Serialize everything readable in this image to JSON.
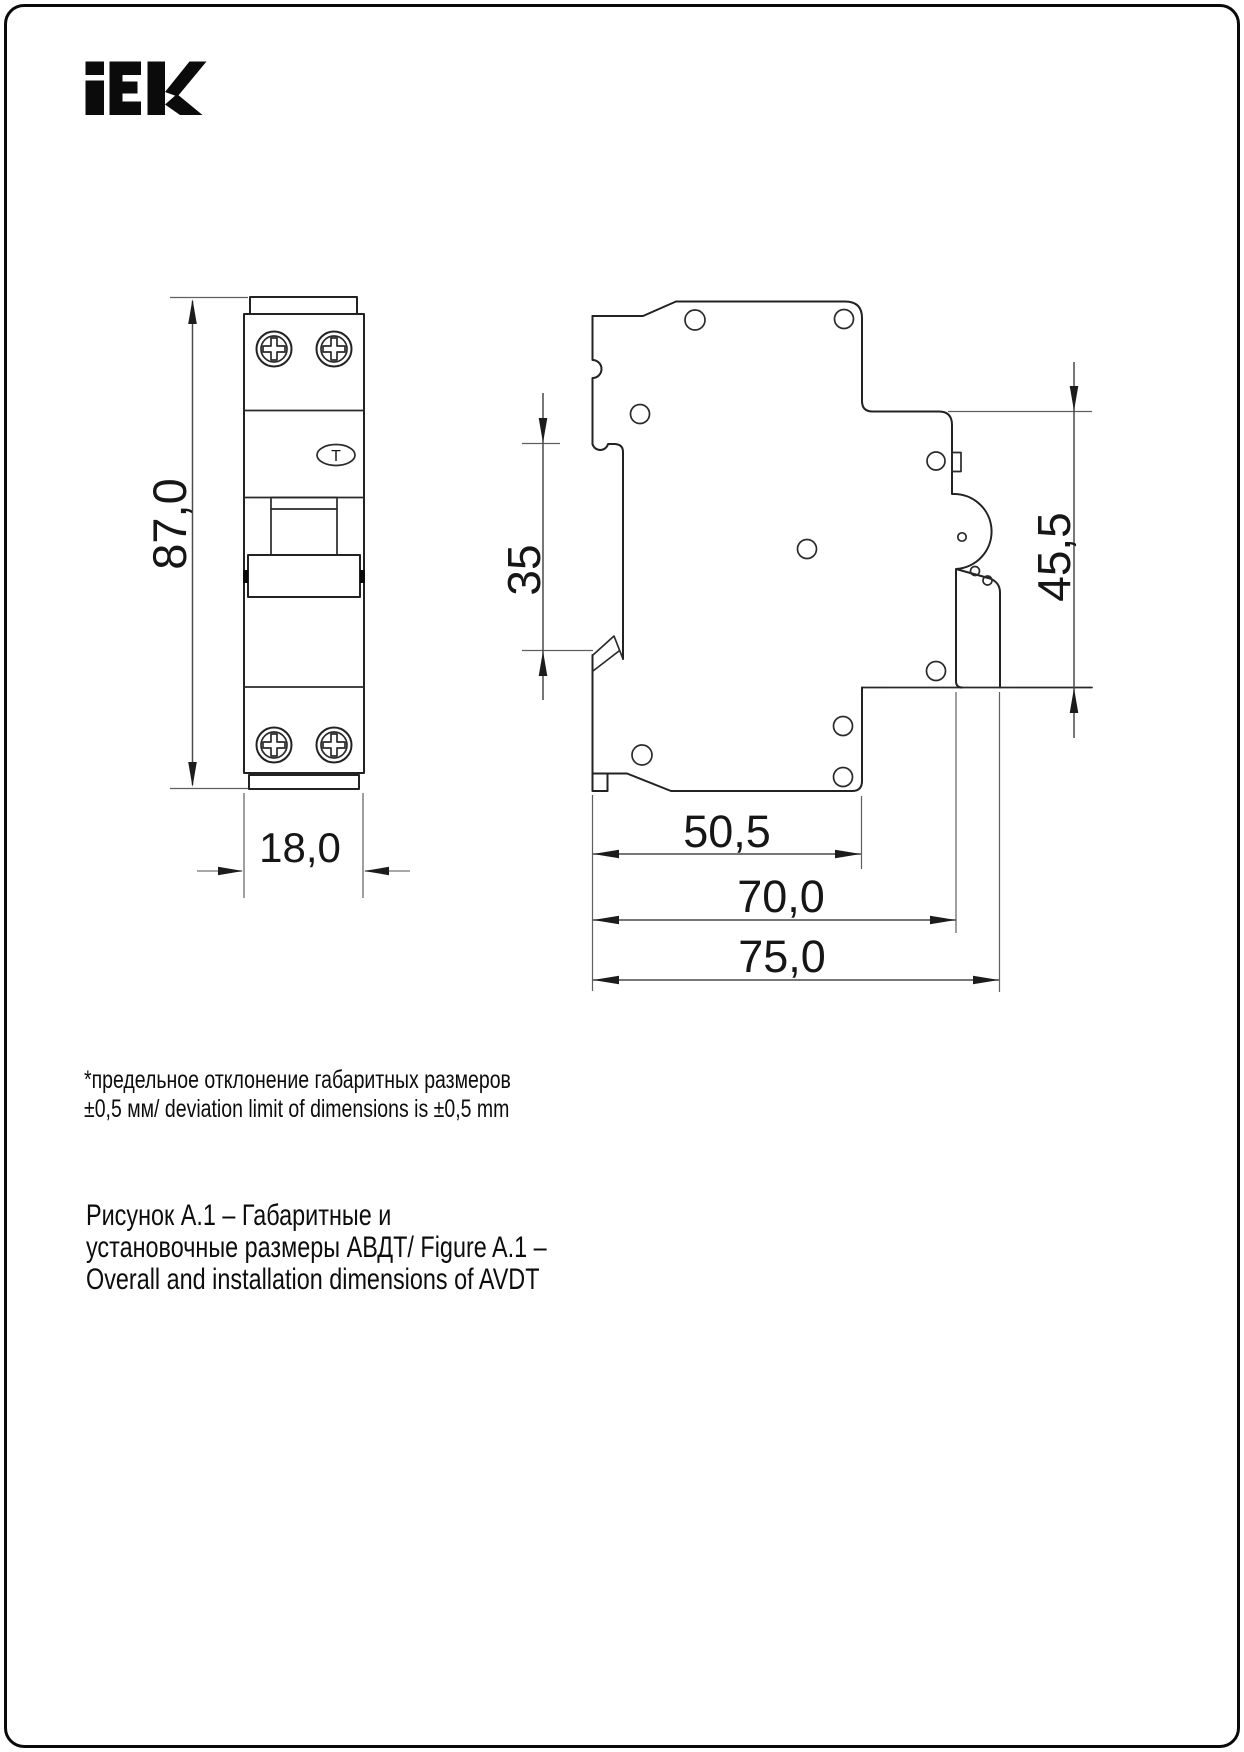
{
  "logo": {
    "text": "iEK"
  },
  "front_view": {
    "test_button_label": "T"
  },
  "dimensions": {
    "front_height": "87,0",
    "front_width": "18,0",
    "din_slot": "35",
    "side_right_height": "45,5",
    "side_depth_case": "50,5",
    "side_depth_rail": "70,0",
    "side_depth_total": "75,0"
  },
  "note": {
    "line1": "*предельное отклонение габаритных размеров",
    "line2": "±0,5 мм/ deviation limit of dimensions is ±0,5 mm"
  },
  "caption": {
    "line1": "Рисунок А.1 – Габаритные и",
    "line2": "установочные размеры АВДТ/ Figure A.1 –",
    "line3": "Overall and installation dimensions of AVDT"
  },
  "colors": {
    "line": "#222222",
    "dimension": "#4a4a4a",
    "background": "#ffffff"
  }
}
